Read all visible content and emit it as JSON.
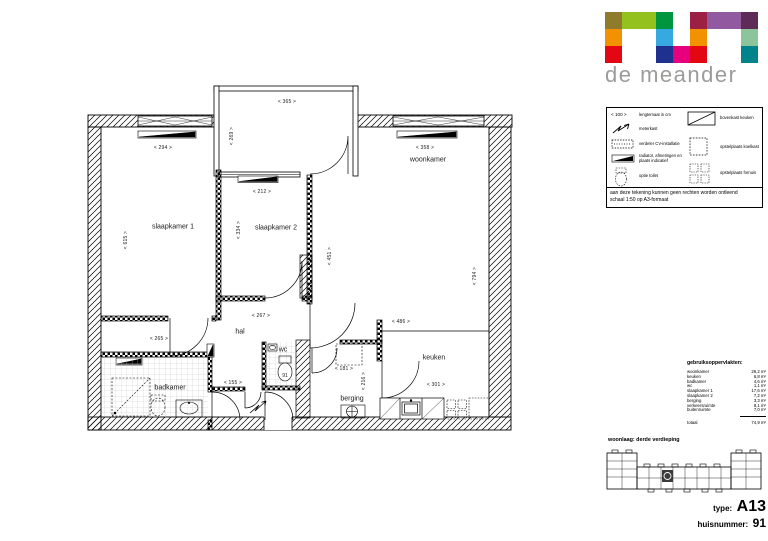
{
  "logo": {
    "title": "de meander",
    "grid": [
      [
        "#8E7C2C",
        "#95C11F",
        "#95C11F",
        "#009640",
        null,
        "#9B2043",
        "#91599F",
        "#91599F",
        "#5D2B55"
      ],
      [
        "#F39200",
        null,
        null,
        "#36A9E1",
        null,
        "#F39200",
        null,
        null,
        "#8CC49B"
      ],
      [
        "#E30613",
        null,
        null,
        "#20308F",
        "#E6007E",
        "#E30613",
        null,
        null,
        "#00838A"
      ]
    ]
  },
  "legend": {
    "dim_symbol": "< 100 >",
    "left": [
      {
        "label": "lengtemaat in cm"
      },
      {
        "label": "meterkast"
      },
      {
        "label": "verdeler CV-installatie"
      },
      {
        "label": "radiator, afmetingen en plaats indicatief"
      },
      {
        "label": "optie toilet"
      }
    ],
    "right": [
      {
        "label": "bovenkast keuken"
      },
      {
        "label": "opstelplaats koelkast"
      },
      {
        "label": "opstelplaats fornuis"
      }
    ],
    "note1": "aan deze tekening kunnen geen rechten worden ontleend",
    "note2": "schaal 1:50  op A3-formaat"
  },
  "areas": {
    "title": "gebruiksoppervlakten:",
    "rows": [
      {
        "name": "woonkamer",
        "value": "26,2 m²"
      },
      {
        "name": "keuken",
        "value": "6,8 m²"
      },
      {
        "name": "badkamer",
        "value": "4,6 m²"
      },
      {
        "name": "wc",
        "value": "1,1 m²"
      },
      {
        "name": "slaapkamer 1",
        "value": "17,6 m²"
      },
      {
        "name": "slaapkamer 2",
        "value": "7,2 m²"
      },
      {
        "name": "berging",
        "value": "3,3 m²"
      },
      {
        "name": "verkeersruimte",
        "value": "8,1 m²"
      },
      {
        "name": "buitenruimte",
        "value": "7,0 m²"
      }
    ],
    "total_name": "totaal",
    "total_value": "74,9 m²"
  },
  "floor": {
    "label": "woonlaag: derde verdieping"
  },
  "type_block": {
    "type_label": "type:",
    "type_value": "A13",
    "number_label": "huisnummer:",
    "number_value": "91"
  },
  "plan": {
    "rooms": {
      "slaapkamer1": "slaapkamer 1",
      "slaapkamer2": "slaapkamer 2",
      "woonkamer": "woonkamer",
      "hal": "hal",
      "wc": "wc",
      "badkamer": "badkamer",
      "berging": "berging",
      "keuken": "keuken"
    },
    "door_number": "91",
    "dims": {
      "d294": "< 294 >",
      "d615": "< 615 >",
      "d365": "< 365 >",
      "d269": "< 269 >",
      "d212": "< 212 >",
      "d334": "< 334 >",
      "d358": "< 358 >",
      "d451": "< 451 >",
      "d794": "< 794 >",
      "d267": "< 267 >",
      "d265": "< 265 >",
      "d155": "< 155 >",
      "d121": "< 121 >",
      "d181": "< 181 >",
      "d216": "< 216 >",
      "d486": "< 486 >",
      "d301": "< 301 >"
    }
  }
}
